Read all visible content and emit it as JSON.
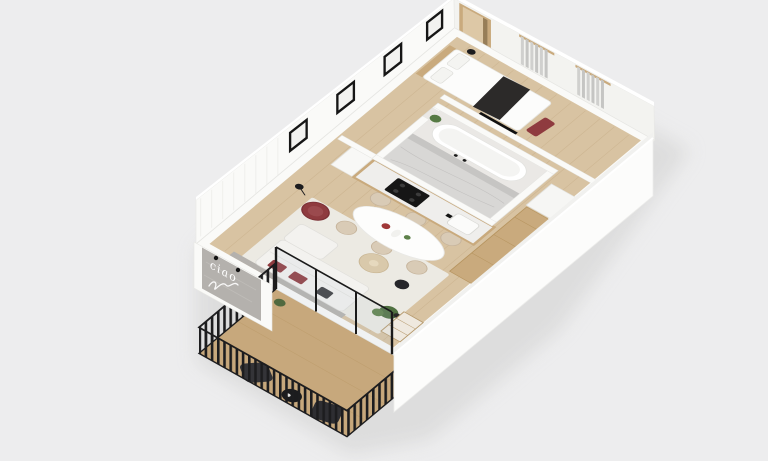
{
  "scene": {
    "type": "3d-floor-plan-render",
    "description": "Isometric 3D render of a one-bedroom apartment with a balcony, floating on a plain light gray backdrop",
    "neon_sign_text": "ciao"
  },
  "colors": {
    "background": "#EDEDEE",
    "wall_white": "#FAFAF8",
    "wall_shade": "#F3F3F0",
    "floor_wood": "#D8C3A2",
    "floor_wood_line": "#C5AC85",
    "balcony_floor": "#C7A87C",
    "rug_cream": "#ECEAE3",
    "concrete_gray": "#B4B1AD",
    "marble_light": "#D8D7D5",
    "marble_dark": "#C6C5C3",
    "bath_floor": "#EAE8E5",
    "cabinet_wood": "#C9AA7D",
    "accent_red": "#8F3B3F",
    "sofa_white": "#F3F2EF",
    "chair_beige": "#D9CBB6",
    "fence_black": "#1D1D1F",
    "plant_green": "#4F7040",
    "appliance_black": "#161616",
    "curtain_gray": "#D0D0CE",
    "throw_charcoal": "#2C2A29",
    "table_white": "#FDFDFC",
    "shadow_gray": "#DCDCDC",
    "neon_white": "#FFFFFF"
  },
  "rooms": [
    {
      "id": "living-room",
      "items": [
        "l-shaped-sofa",
        "red-armchair",
        "coffee-table",
        "floor-lamp",
        "concrete-accent-wall",
        "neon-wall-sign",
        "cream-rug",
        "potted-plant",
        "black-pouf",
        "display-cabinet"
      ]
    },
    {
      "id": "dining-area",
      "items": [
        "oval-dining-table",
        "dining-chairs-x6",
        "wood-sideboard",
        "white-bench"
      ]
    },
    {
      "id": "kitchen",
      "items": [
        "wood-cabinet-run",
        "black-cooktop",
        "sink-with-faucet",
        "tall-cabinet"
      ]
    },
    {
      "id": "bathroom",
      "items": [
        "marble-walk-in-shower",
        "marble-feature-wall",
        "freestanding-bathtub",
        "plant",
        "wall-faucet"
      ]
    },
    {
      "id": "hallway",
      "items": [
        "gallery-picture-frames",
        "wall-paneling",
        "entry-door"
      ]
    },
    {
      "id": "bedroom",
      "items": [
        "double-bed",
        "pillows",
        "charcoal-throw",
        "wood-headboard",
        "red-bench",
        "bedside-table",
        "tv-panel",
        "gray-curtains"
      ]
    },
    {
      "id": "balcony",
      "items": [
        "black-slatted-railing",
        "lounge-chair",
        "lounge-chair",
        "round-side-table",
        "glass-sliding-door",
        "plant"
      ]
    }
  ]
}
